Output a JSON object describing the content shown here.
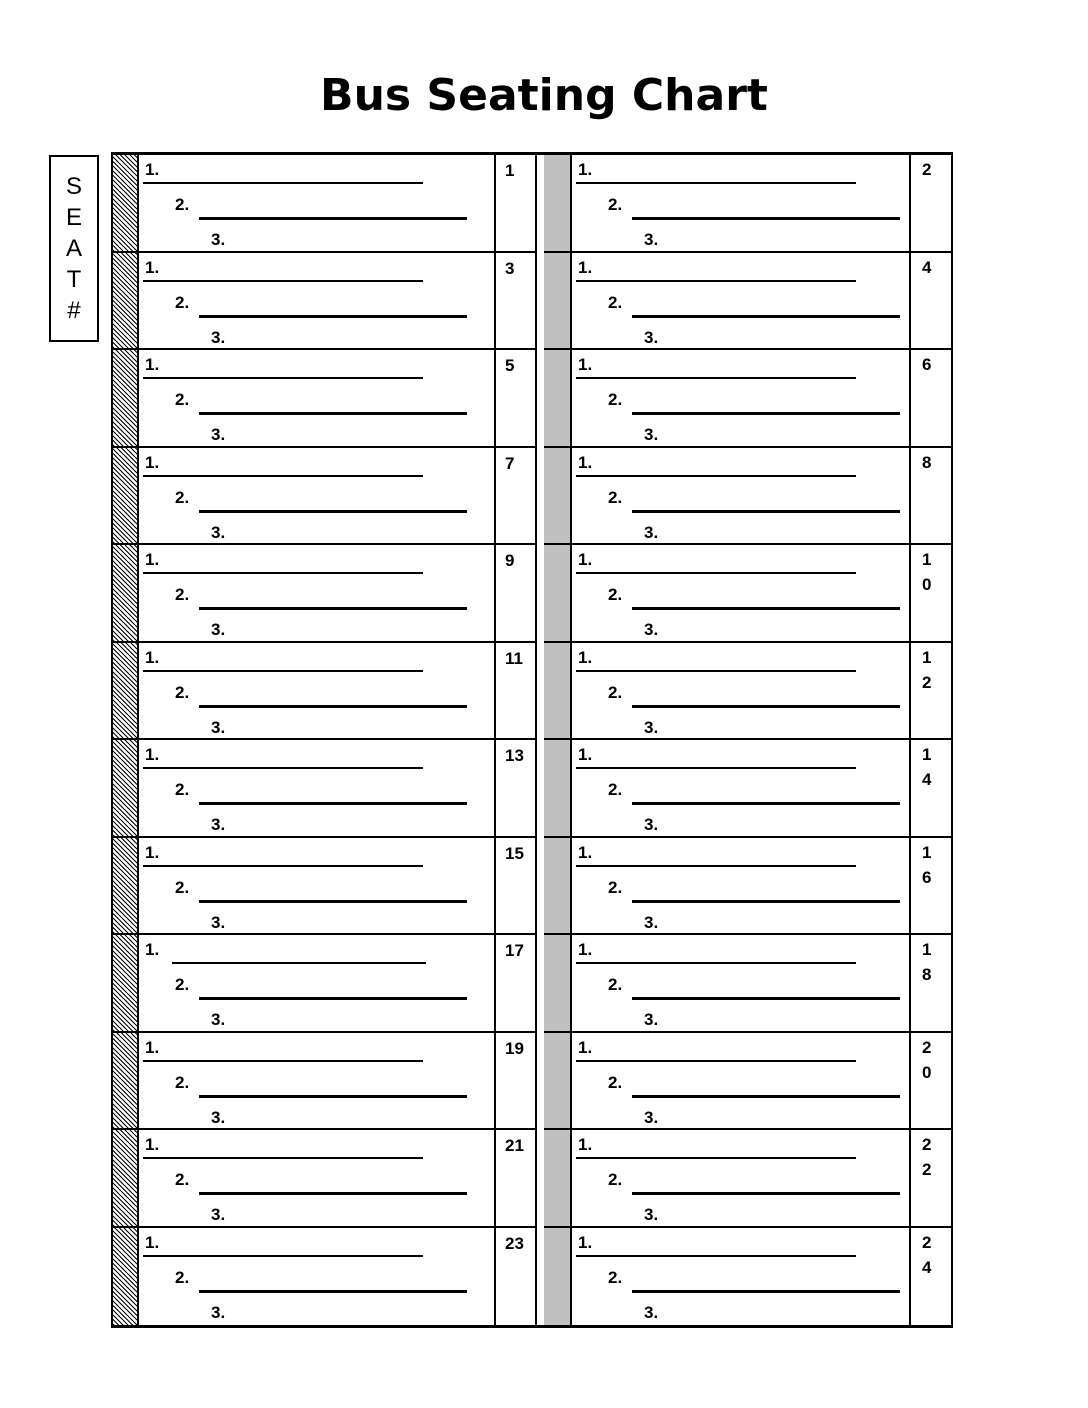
{
  "title": "Bus Seating Chart",
  "seat_header": [
    "S",
    "E",
    "A",
    "T",
    "#"
  ],
  "entry_labels": [
    "1.",
    "2.",
    "3."
  ],
  "rows": [
    {
      "left": "1",
      "right": "2"
    },
    {
      "left": "3",
      "right": "4"
    },
    {
      "left": "5",
      "right": "6"
    },
    {
      "left": "7",
      "right": "8"
    },
    {
      "left": "9",
      "right": "10"
    },
    {
      "left": "11",
      "right": "12"
    },
    {
      "left": "13",
      "right": "14"
    },
    {
      "left": "15",
      "right": "16"
    },
    {
      "left": "17",
      "right": "18",
      "left_line1_detached": true
    },
    {
      "left": "19",
      "right": "20"
    },
    {
      "left": "21",
      "right": "22"
    },
    {
      "left": "23",
      "right": "24"
    }
  ],
  "colors": {
    "aisle": "#c0c0c0",
    "ink": "#000000"
  }
}
